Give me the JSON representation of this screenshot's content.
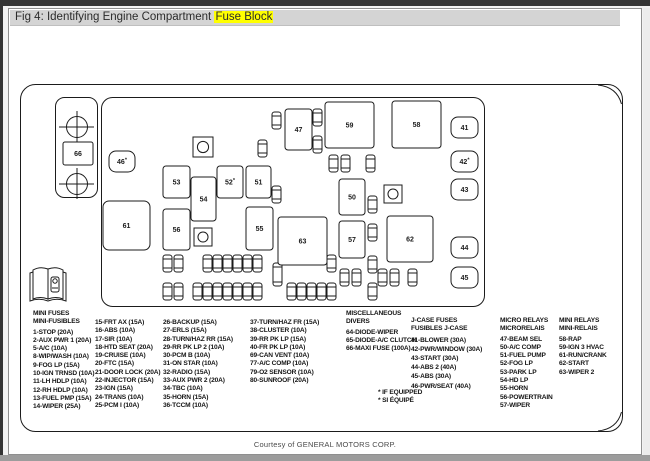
{
  "title": {
    "prefix": "Fig 4: Identifying Engine Compartment ",
    "highlight": "Fuse Block"
  },
  "footer": {
    "credit": "Courtesy of GENERAL MOTORS CORP."
  },
  "colors": {
    "search_highlight": "#ffff00",
    "line_art": "#1b1b1b",
    "title_bar_bg": "#d4d4d4",
    "window_edge": "#343434"
  },
  "diagram": {
    "terminal_strip": {
      "x": 55.5,
      "y": 97.5,
      "w": 42,
      "h": 100,
      "terminals": [
        {
          "cx": 77,
          "cy": 127
        },
        {
          "cx": 77,
          "cy": 184
        }
      ]
    },
    "body": {
      "x": 101.5,
      "y": 97.5,
      "w": 383,
      "h": 209
    },
    "panel": {
      "x": 20.5,
      "y": 84.5,
      "w": 602,
      "h": 347
    },
    "mount_holes": [
      [
        193,
        137,
        20
      ],
      [
        384,
        185,
        18
      ],
      [
        194,
        228,
        18
      ]
    ],
    "components": [
      {
        "label": "66",
        "x": 63,
        "y": 142,
        "w": 30,
        "h": 23,
        "rx": 2
      },
      {
        "label": "46*",
        "x": 109,
        "y": 151,
        "w": 26,
        "h": 21,
        "rx": 7
      },
      {
        "label": "53",
        "x": 163,
        "y": 166,
        "w": 27,
        "h": 32,
        "rx": 3
      },
      {
        "label": "54",
        "x": 191,
        "y": 177,
        "w": 25,
        "h": 44,
        "rx": 3
      },
      {
        "label": "52*",
        "x": 217,
        "y": 166,
        "w": 26,
        "h": 32,
        "rx": 3
      },
      {
        "label": "51",
        "x": 246,
        "y": 166,
        "w": 25,
        "h": 32,
        "rx": 3
      },
      {
        "label": "47",
        "x": 285,
        "y": 109,
        "w": 27,
        "h": 41,
        "rx": 3
      },
      {
        "label": "59",
        "x": 325,
        "y": 102,
        "w": 49,
        "h": 46,
        "rx": 3
      },
      {
        "label": "58",
        "x": 392,
        "y": 101,
        "w": 49,
        "h": 47,
        "rx": 3
      },
      {
        "label": "61",
        "x": 103,
        "y": 201,
        "w": 47,
        "h": 49,
        "rx": 6
      },
      {
        "label": "56",
        "x": 163,
        "y": 209,
        "w": 27,
        "h": 41,
        "rx": 3
      },
      {
        "label": "55",
        "x": 246,
        "y": 207,
        "w": 27,
        "h": 43,
        "rx": 3
      },
      {
        "label": "63",
        "x": 278,
        "y": 217,
        "w": 49,
        "h": 48,
        "rx": 3
      },
      {
        "label": "50",
        "x": 339,
        "y": 179,
        "w": 26,
        "h": 36,
        "rx": 3
      },
      {
        "label": "57",
        "x": 339,
        "y": 221,
        "w": 26,
        "h": 37,
        "rx": 3
      },
      {
        "label": "62",
        "x": 387,
        "y": 216,
        "w": 46,
        "h": 46,
        "rx": 3
      },
      {
        "label": "41",
        "x": 451,
        "y": 117,
        "w": 27,
        "h": 21,
        "rx": 7
      },
      {
        "label": "42*",
        "x": 451,
        "y": 151,
        "w": 27,
        "h": 21,
        "rx": 7
      },
      {
        "label": "43",
        "x": 451,
        "y": 179,
        "w": 27,
        "h": 21,
        "rx": 7
      },
      {
        "label": "44",
        "x": 451,
        "y": 237,
        "w": 27,
        "h": 21,
        "rx": 7
      },
      {
        "label": "45",
        "x": 451,
        "y": 267,
        "w": 27,
        "h": 21,
        "rx": 7
      }
    ],
    "mini_fuses": [
      [
        272,
        112
      ],
      [
        313,
        109
      ],
      [
        313,
        136
      ],
      [
        258,
        140
      ],
      [
        272,
        186
      ],
      [
        329,
        155
      ],
      [
        341,
        155
      ],
      [
        366,
        155
      ],
      [
        368,
        196
      ],
      [
        368,
        224
      ],
      [
        368,
        256
      ],
      [
        368,
        283
      ],
      [
        163,
        255
      ],
      [
        174,
        255
      ],
      [
        203,
        255
      ],
      [
        213,
        255
      ],
      [
        223,
        255
      ],
      [
        233,
        255
      ],
      [
        243,
        255
      ],
      [
        253,
        255
      ],
      [
        327,
        255
      ],
      [
        163,
        283
      ],
      [
        174,
        283
      ],
      [
        193,
        283
      ],
      [
        203,
        283
      ],
      [
        213,
        283
      ],
      [
        223,
        283
      ],
      [
        233,
        283
      ],
      [
        243,
        283
      ],
      [
        253,
        283
      ],
      [
        287,
        283
      ],
      [
        297,
        283
      ],
      [
        307,
        283
      ],
      [
        317,
        283
      ],
      [
        327,
        283
      ],
      [
        340,
        269
      ],
      [
        352,
        269
      ],
      [
        378,
        269
      ],
      [
        390,
        269
      ],
      [
        408,
        269
      ],
      [
        273,
        263,
        23
      ]
    ]
  },
  "legend": {
    "columns": [
      {
        "name": "legend-mini-fuses-1",
        "x": 33,
        "y": 310,
        "header": [
          "MINI FUSES",
          "MINI-FUSIBLES"
        ],
        "items": [
          "1-STOP (20A)",
          "2-AUX PWR 1 (20A)",
          "5-A/C (10A)",
          "8-WIP/WASH (10A)",
          "9-FOG LP (15A)",
          "10-IGN TRNSD (10A)",
          "11-LH HDLP (10A)",
          "12-RH HDLP (10A)",
          "13-FUEL PMP (15A)",
          "14-WIPER (25A)"
        ]
      },
      {
        "name": "legend-mini-fuses-2",
        "x": 95,
        "y": 319,
        "items": [
          "15-FRT AX (15A)",
          "16-ABS (10A)",
          "17-SIR (10A)",
          "18-HTD SEAT (20A)",
          "19-CRUISE (10A)",
          "20-FTC (15A)",
          "21-DOOR LOCK (20A)",
          "22-INJECTOR (15A)",
          "23-IGN (15A)",
          "24-TRANS (10A)",
          "25-PCM I (10A)"
        ]
      },
      {
        "name": "legend-mini-fuses-3",
        "x": 163,
        "y": 319,
        "items": [
          "26-BACKUP (15A)",
          "27-ERLS (15A)",
          "28-TURN/HAZ RR (15A)",
          "29-RR PK LP 2 (10A)",
          "30-PCM B (10A)",
          "31-ON STAR (10A)",
          "32-RADIO (15A)",
          "33-AUX PWR 2 (20A)",
          "34-TBC (10A)",
          "35-HORN (15A)",
          "36-TCCM (10A)"
        ]
      },
      {
        "name": "legend-mini-fuses-4",
        "x": 250,
        "y": 319,
        "items": [
          "37-TURN/HAZ FR (15A)",
          "38-CLUSTER (10A)",
          "39-RR PK LP (15A)",
          "40-FR PK LP (10A)",
          "69-CAN VENT (10A)",
          "77-A/C COMP (10A)",
          "79-O2 SENSOR (10A)",
          "80-SUNROOF (20A)"
        ]
      },
      {
        "name": "legend-miscellaneous",
        "x": 346,
        "y": 310,
        "header": [
          "MISCELLANEOUS",
          "DIVERS"
        ],
        "items": [
          "64-DIODE-WIPER",
          "65-DIODE-A/C CLUTCH",
          "66-MAXI FUSE (100A)"
        ]
      },
      {
        "name": "legend-jcase-fuses",
        "x": 411,
        "y": 317,
        "lh": 9.2,
        "header": [
          "J-CASE FUSES",
          "FUSIBLES J-CASE"
        ],
        "items": [
          "41-BLOWER (30A)",
          "42-PWR/WINDOW (30A)",
          "43-START (30A)",
          "44-ABS 2 (40A)",
          "45-ABS (30A)",
          "46-PWR/SEAT (40A)"
        ]
      },
      {
        "name": "legend-micro-relays",
        "x": 500,
        "y": 317,
        "header": [
          "MICRO RELAYS",
          "MICRORELAIS"
        ],
        "items": [
          "47-BEAM SEL",
          "50-A/C COMP",
          "51-FUEL PUMP",
          "52-FOG LP",
          "53-PARK LP",
          "54-HD LP",
          "55-HORN",
          "56-POWERTRAIN",
          "57-WIPER"
        ]
      },
      {
        "name": "legend-mini-relays",
        "x": 559,
        "y": 317,
        "header": [
          "MINI RELAYS",
          "MINI-RELAIS"
        ],
        "items": [
          "58-RAP",
          "59-IGN 3 HVAC",
          "61-RUN/CRANK",
          "62-START",
          "63-WIPER 2"
        ]
      },
      {
        "name": "legend-if-equipped-note",
        "x": 378,
        "y": 389,
        "items": [
          "* IF EQUIPPED",
          "* SI ÉQUIPÉ"
        ]
      }
    ]
  }
}
